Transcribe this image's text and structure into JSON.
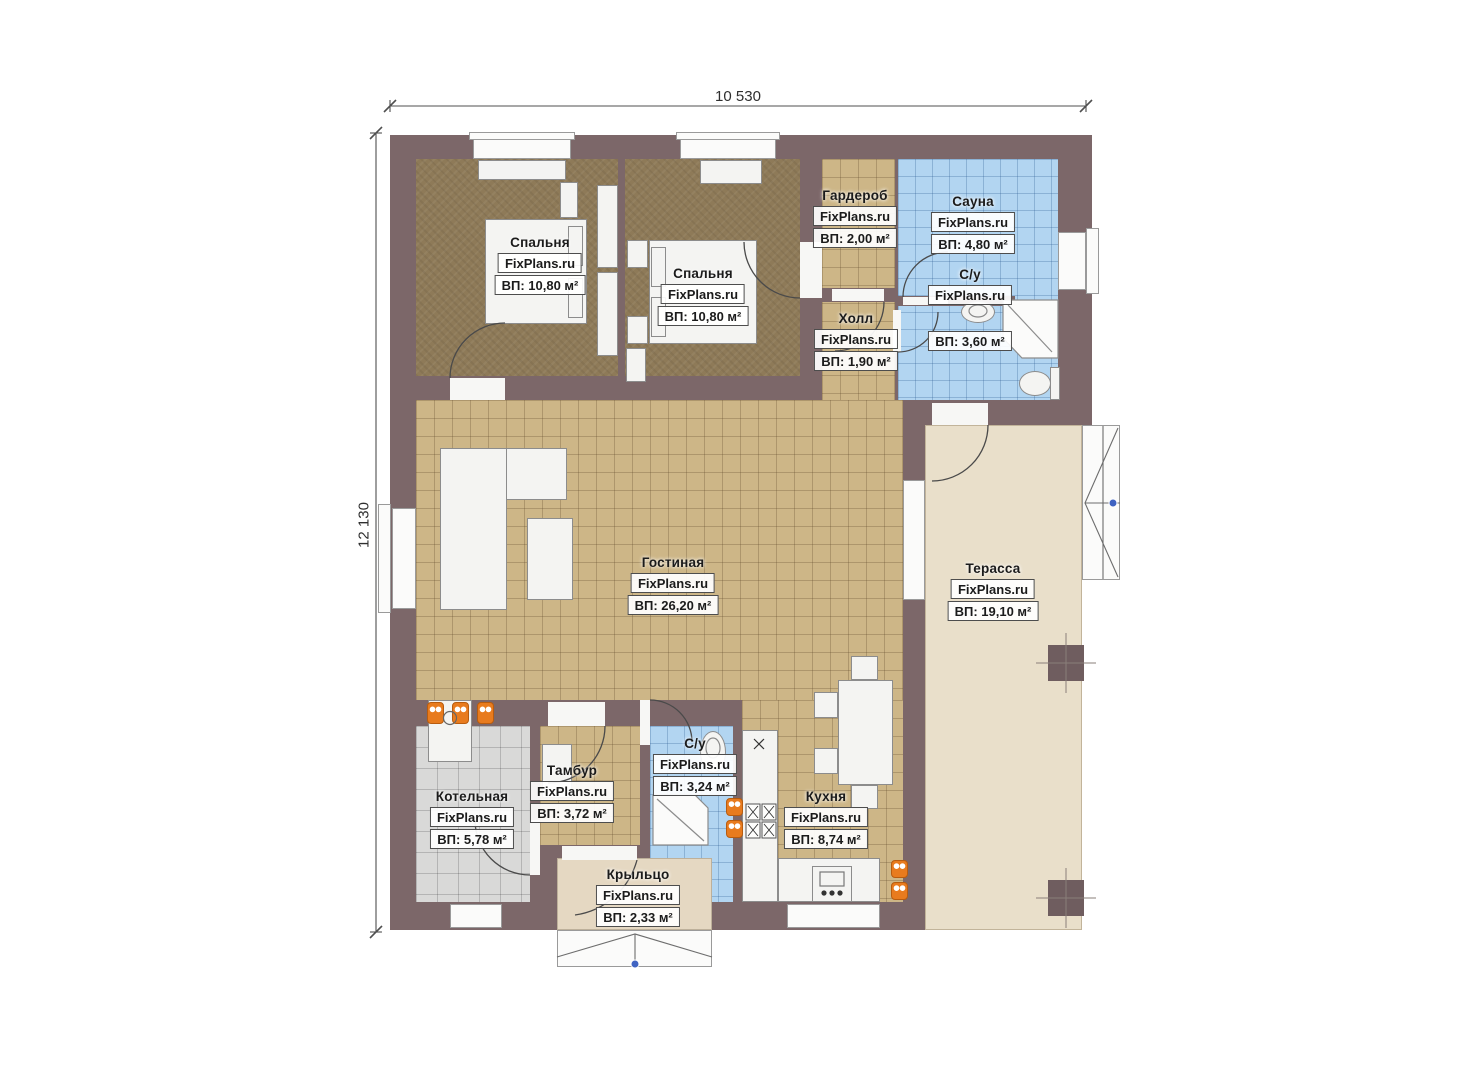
{
  "watermark": "FixPlans.ru",
  "dimensions": {
    "width_label": "10 530",
    "height_label": "12 130"
  },
  "rooms": [
    {
      "id": "bedroom-1",
      "name": "Спальня",
      "area": "ВП: 10,80 м²"
    },
    {
      "id": "bedroom-2",
      "name": "Спальня",
      "area": "ВП: 10,80 м²"
    },
    {
      "id": "wardrobe",
      "name": "Гардероб",
      "area": "ВП: 2,00 м²"
    },
    {
      "id": "sauna",
      "name": "Сауна",
      "area": "ВП: 4,80 м²"
    },
    {
      "id": "bathroom-1",
      "name": "С/у",
      "area": "ВП: 3,60 м²"
    },
    {
      "id": "hall",
      "name": "Холл",
      "area": "ВП: 1,90 м²"
    },
    {
      "id": "living-room",
      "name": "Гостиная",
      "area": "ВП: 26,20 м²"
    },
    {
      "id": "terrace",
      "name": "Терасса",
      "area": "ВП: 19,10 м²"
    },
    {
      "id": "boiler-room",
      "name": "Котельная",
      "area": "ВП: 5,78 м²"
    },
    {
      "id": "vestibule",
      "name": "Тамбур",
      "area": "ВП: 3,72 м²"
    },
    {
      "id": "bathroom-2",
      "name": "С/у",
      "area": "ВП: 3,24 м²"
    },
    {
      "id": "kitchen",
      "name": "Кухня",
      "area": "ВП: 8,74 м²"
    },
    {
      "id": "porch",
      "name": "Крыльцо",
      "area": "ВП: 2,33 м²"
    }
  ],
  "colors": {
    "wall": "#7c6769",
    "bedroom_floor": "#8e7a58",
    "tile_floor": "#cdb687",
    "wet_room_floor": "#b2d5f1",
    "boiler_floor": "#d9d9d8",
    "terrace_floor": "#e9dfca",
    "radiator_orange": "#e87b1e",
    "marker_blue": "#3f63c2"
  }
}
